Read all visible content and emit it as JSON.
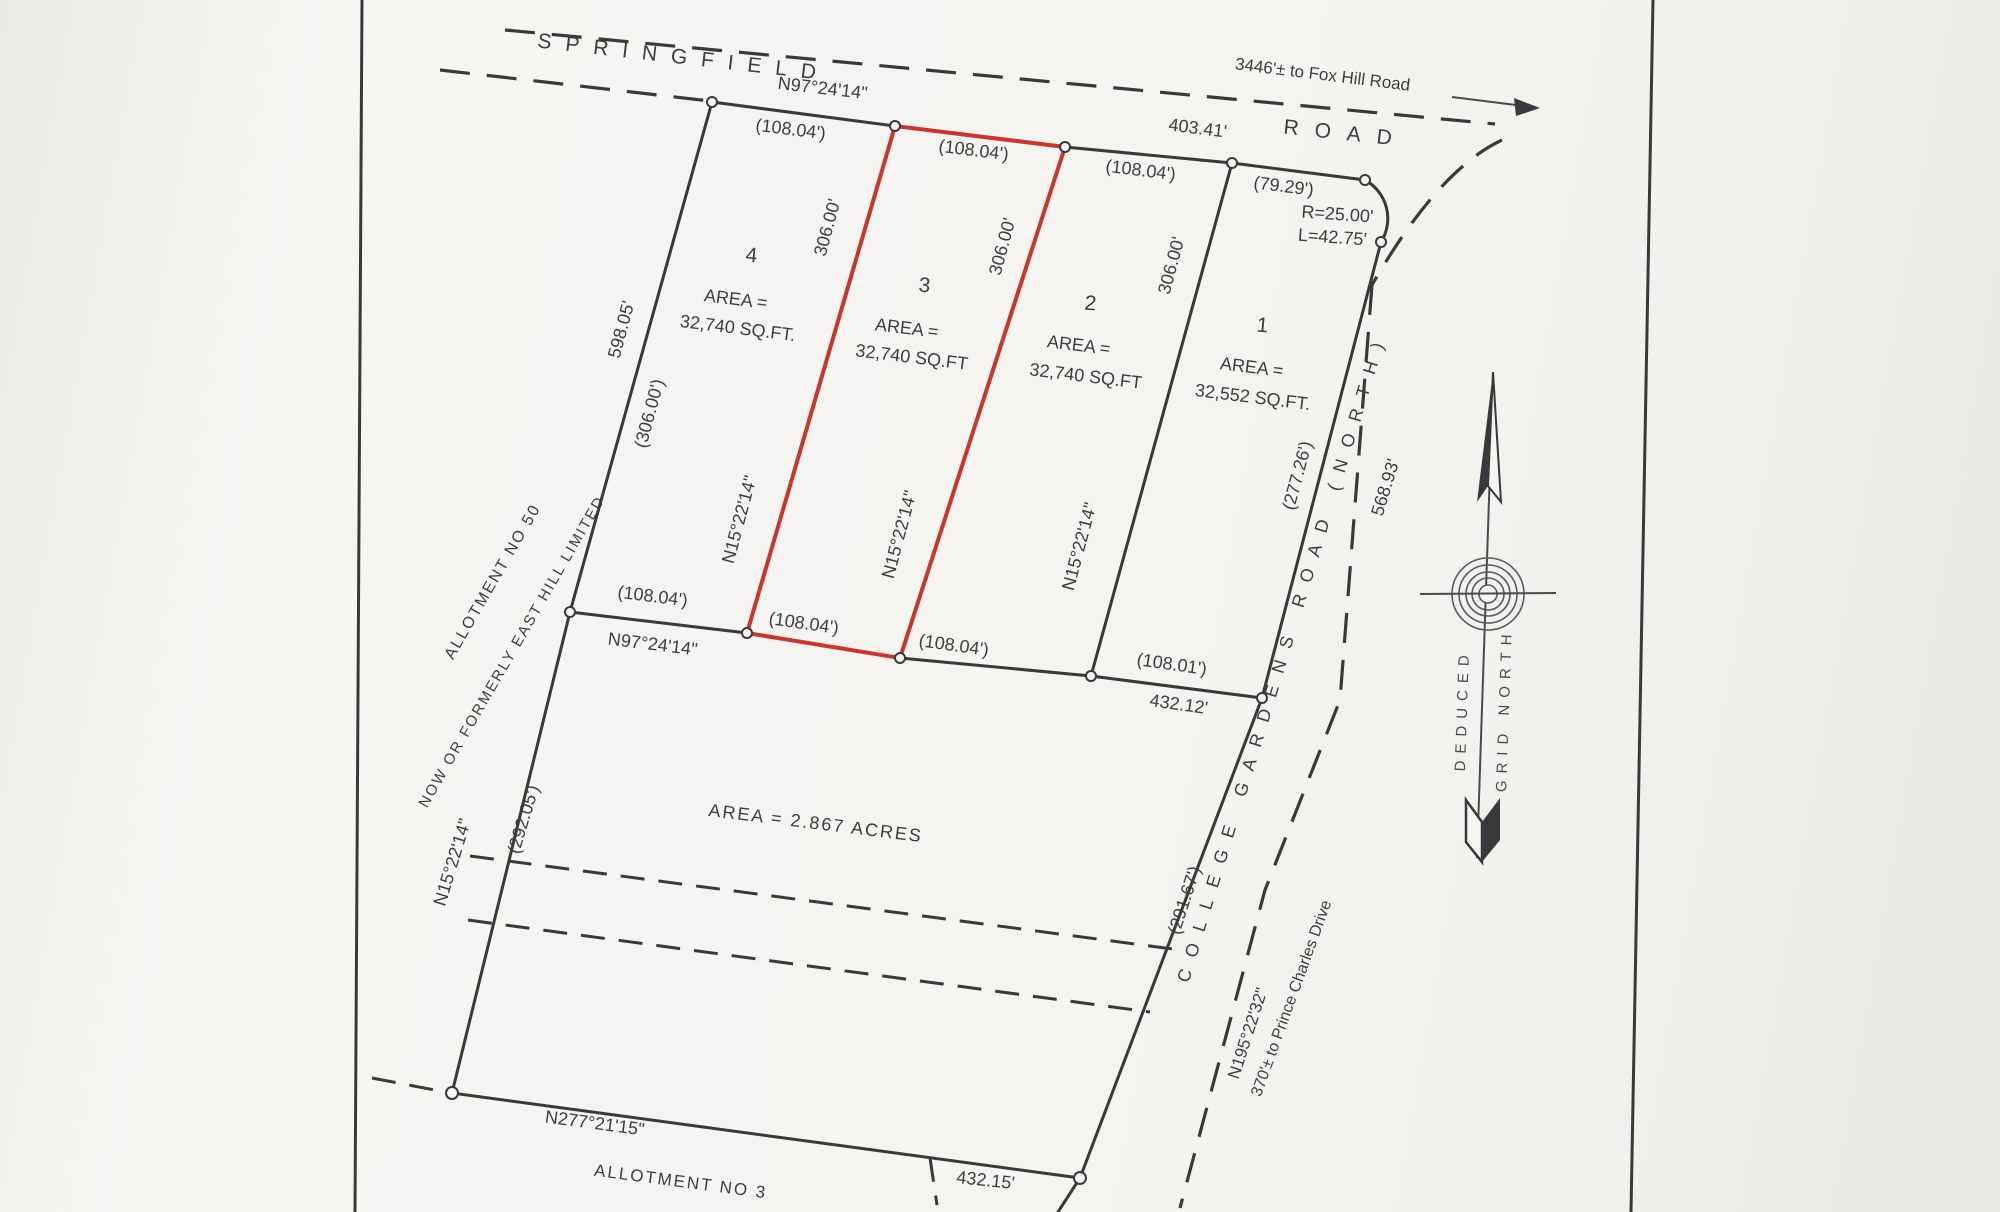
{
  "roads": {
    "springfield_name": "SPRINGFIELD",
    "springfield_word_road": "ROAD",
    "fox_hill_note": "3446'± to Fox Hill Road",
    "college_gardens_name": "COLLEGE GARDENS ROAD (NORTH)",
    "college_frontage_paren": "(277.26')",
    "college_total": "568.93'",
    "college_lower_paren": "(291.67')",
    "college_bearing": "N195°22'32\"",
    "prince_charles_note": "370'± to Prince Charles Drive"
  },
  "top_line": {
    "bearing": "N97°24'14\"",
    "seg1": "(108.04')",
    "seg2": "(108.04')",
    "seg3": "(108.04')",
    "seg4": "(79.29')",
    "total": "403.41'",
    "curve_radius": "R=25.00'",
    "curve_length": "L=42.75'"
  },
  "bottom_line": {
    "bearing": "N97°24'14\"",
    "seg1": "(108.04')",
    "seg2": "(108.04')",
    "seg3": "(108.04')",
    "seg4": "(108.01')",
    "total": "432.12'"
  },
  "west_side": {
    "upper_dist": "598.05'",
    "upper_paren": "(306.00')",
    "lower_bearing": "N15°22'14\"",
    "lower_paren": "(292.05')"
  },
  "side_lines": {
    "bearing": "N15°22'14\"",
    "dist": "306.00'"
  },
  "south_side": {
    "bearing": "N277°21'15\"",
    "total": "432.15'"
  },
  "lots": [
    {
      "number": "1",
      "area_label": "AREA =",
      "area_value": "32,552 SQ.FT."
    },
    {
      "number": "2",
      "area_label": "AREA =",
      "area_value": "32,740 SQ.FT"
    },
    {
      "number": "3",
      "area_label": "AREA =",
      "area_value": "32,740 SQ.FT"
    },
    {
      "number": "4",
      "area_label": "AREA =",
      "area_value": "32,740 SQ.FT."
    }
  ],
  "parcel": {
    "area": "AREA = 2.867 ACRES"
  },
  "allotment_50": {
    "line1": "ALLOTMENT NO 50",
    "line2": "NOW OR FORMERLY EAST HILL LIMITED"
  },
  "allotment_3": "ALLOTMENT NO 3",
  "north_arrow": {
    "word1": "DEDUCED",
    "word2": "GRID NORTH"
  }
}
